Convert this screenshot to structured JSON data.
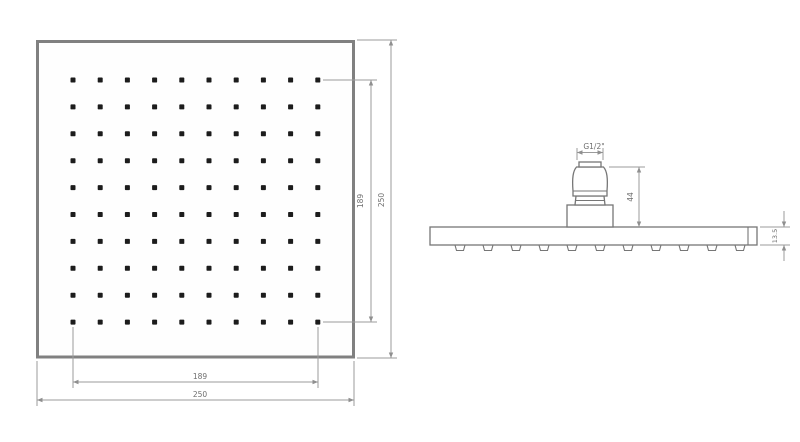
{
  "front_view": {
    "nozzle_grid": {
      "rows": 10,
      "cols": 10
    },
    "dim_hole_span_vertical": "189",
    "dim_overall_vertical": "250",
    "dim_hole_span_horizontal": "189",
    "dim_overall_horizontal": "250"
  },
  "side_view": {
    "thread_label": "G1/2\"",
    "dim_connector_height": "44",
    "dim_plate_thickness": "13.5",
    "nozzle_count": 11
  },
  "colors": {
    "outline": "#808080",
    "part_line": "#767676",
    "dimension_line": "#9b9b9b",
    "dot": "#1c1c1c",
    "label_text": "#6e6e6e",
    "background": "#ffffff"
  }
}
